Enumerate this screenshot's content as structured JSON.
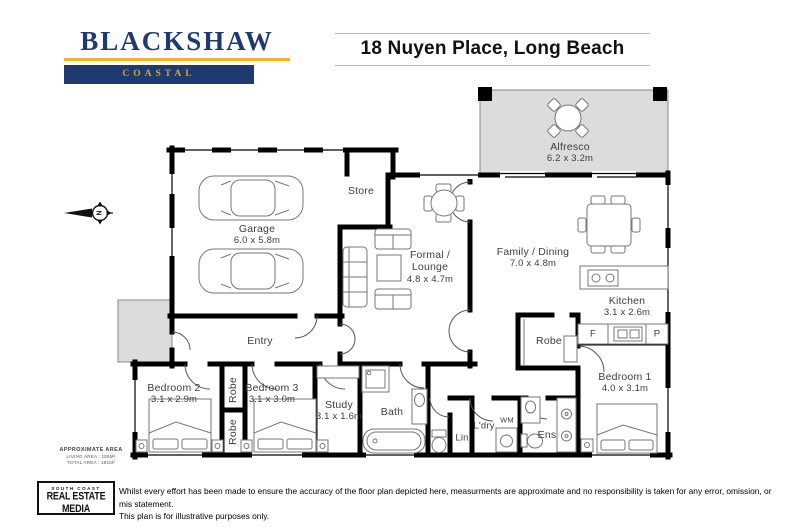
{
  "header": {
    "brand": {
      "name": "BLACKSHAW",
      "division": "COASTAL",
      "navy": "#1e3a6e",
      "gold": "#f0b429"
    },
    "title": "18 Nuyen Place, Long Beach"
  },
  "compass": {
    "label": "N"
  },
  "rooms": {
    "garage": {
      "name": "Garage",
      "dims": "6.0 x 5.8m"
    },
    "store": {
      "name": "Store"
    },
    "formal_lounge": {
      "name1": "Formal /",
      "name2": "Lounge",
      "dims": "4.8 x 4.7m"
    },
    "family_dining": {
      "name": "Family / Dining",
      "dims": "7.0 x 4.8m"
    },
    "alfresco": {
      "name": "Alfresco",
      "dims": "6.2 x 3.2m"
    },
    "kitchen": {
      "name": "Kitchen",
      "dims": "3.1 x 2.6m"
    },
    "entry": {
      "name": "Entry"
    },
    "bedroom1": {
      "name": "Bedroom 1",
      "dims": "4.0 x 3.1m"
    },
    "bedroom2": {
      "name": "Bedroom 2",
      "dims": "3.1 x 2.9m"
    },
    "bedroom3": {
      "name": "Bedroom 3",
      "dims": "3.1 x 3.0m"
    },
    "study": {
      "name": "Study",
      "dims": "3.1 x 1.6m"
    },
    "bath": {
      "name": "Bath"
    },
    "laundry": {
      "name": "L'dry"
    },
    "wm": {
      "name": "WM"
    },
    "linen": {
      "name": "Lin"
    },
    "ensuite": {
      "name": "Ens"
    },
    "robe_walkin": {
      "name": "Robe"
    },
    "robe_hall_a": {
      "name": "Robe"
    },
    "robe_hall_b": {
      "name": "Robe"
    },
    "fridge": {
      "name": "F"
    },
    "pantry": {
      "name": "P"
    }
  },
  "footer": {
    "area": {
      "heading": "APPROXIMATE AREA",
      "living": "LIVING AREA : 155M²",
      "total": "TOTAL AREA : 191M²"
    },
    "media_logo": {
      "top": "SOUTH COAST",
      "main": "REAL ESTATE MEDIA"
    },
    "disclaimer_line1": "Whilst every effort has been made to ensure the accuracy of the floor plan depicted here, measurments are approximate and no responsibility is taken for any error, omission, or mis statement.",
    "disclaimer_line2": "This plan is for illustrative purposes only."
  }
}
